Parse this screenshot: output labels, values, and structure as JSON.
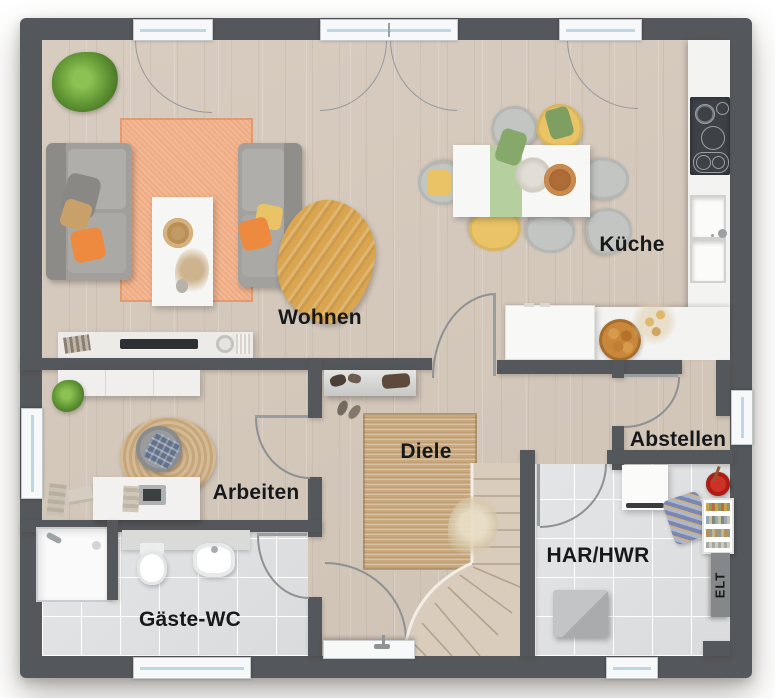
{
  "rooms": {
    "wohnen": {
      "label": "Wohnen"
    },
    "kueche": {
      "label": "Küche"
    },
    "arbeiten": {
      "label": "Arbeiten"
    },
    "diele": {
      "label": "Diele"
    },
    "abstellen": {
      "label": "Abstellen"
    },
    "har_hwr": {
      "label": "HAR/HWR"
    },
    "gaeste_wc": {
      "label": "Gäste-WC"
    },
    "elt": {
      "label": "ELT"
    }
  },
  "colors": {
    "wall": "#54575b",
    "wood": "#d8ccc0",
    "tile": "#e3e5e6",
    "jute": "#c9a87d",
    "rugPeach": "#efab82",
    "orange": "#ee8a3f",
    "yellow": "#e9c366",
    "mustard": "#d9a550",
    "green": "#6fa63e",
    "sage": "#b6cf9f",
    "red": "#cf3126",
    "glass": "#bdd7e5",
    "counter": "#f3f3f1",
    "appliance": "#3e4247",
    "ink": "#17181a"
  }
}
